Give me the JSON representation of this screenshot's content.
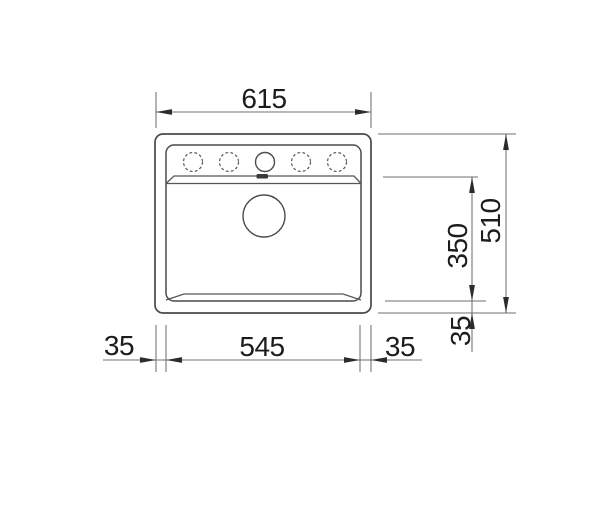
{
  "colors": {
    "background": "#ffffff",
    "outline_ink": "#4a4a4a",
    "dimension_line": "#6f6f6f",
    "text_ink": "#1c1c1c"
  },
  "drawing": {
    "dimensions": {
      "overall_width": "615",
      "overall_depth": "510",
      "bowl_width": "545",
      "bowl_front_to_back": "350",
      "rim_left": "35",
      "rim_right": "35",
      "rim_bottom": "35"
    }
  }
}
